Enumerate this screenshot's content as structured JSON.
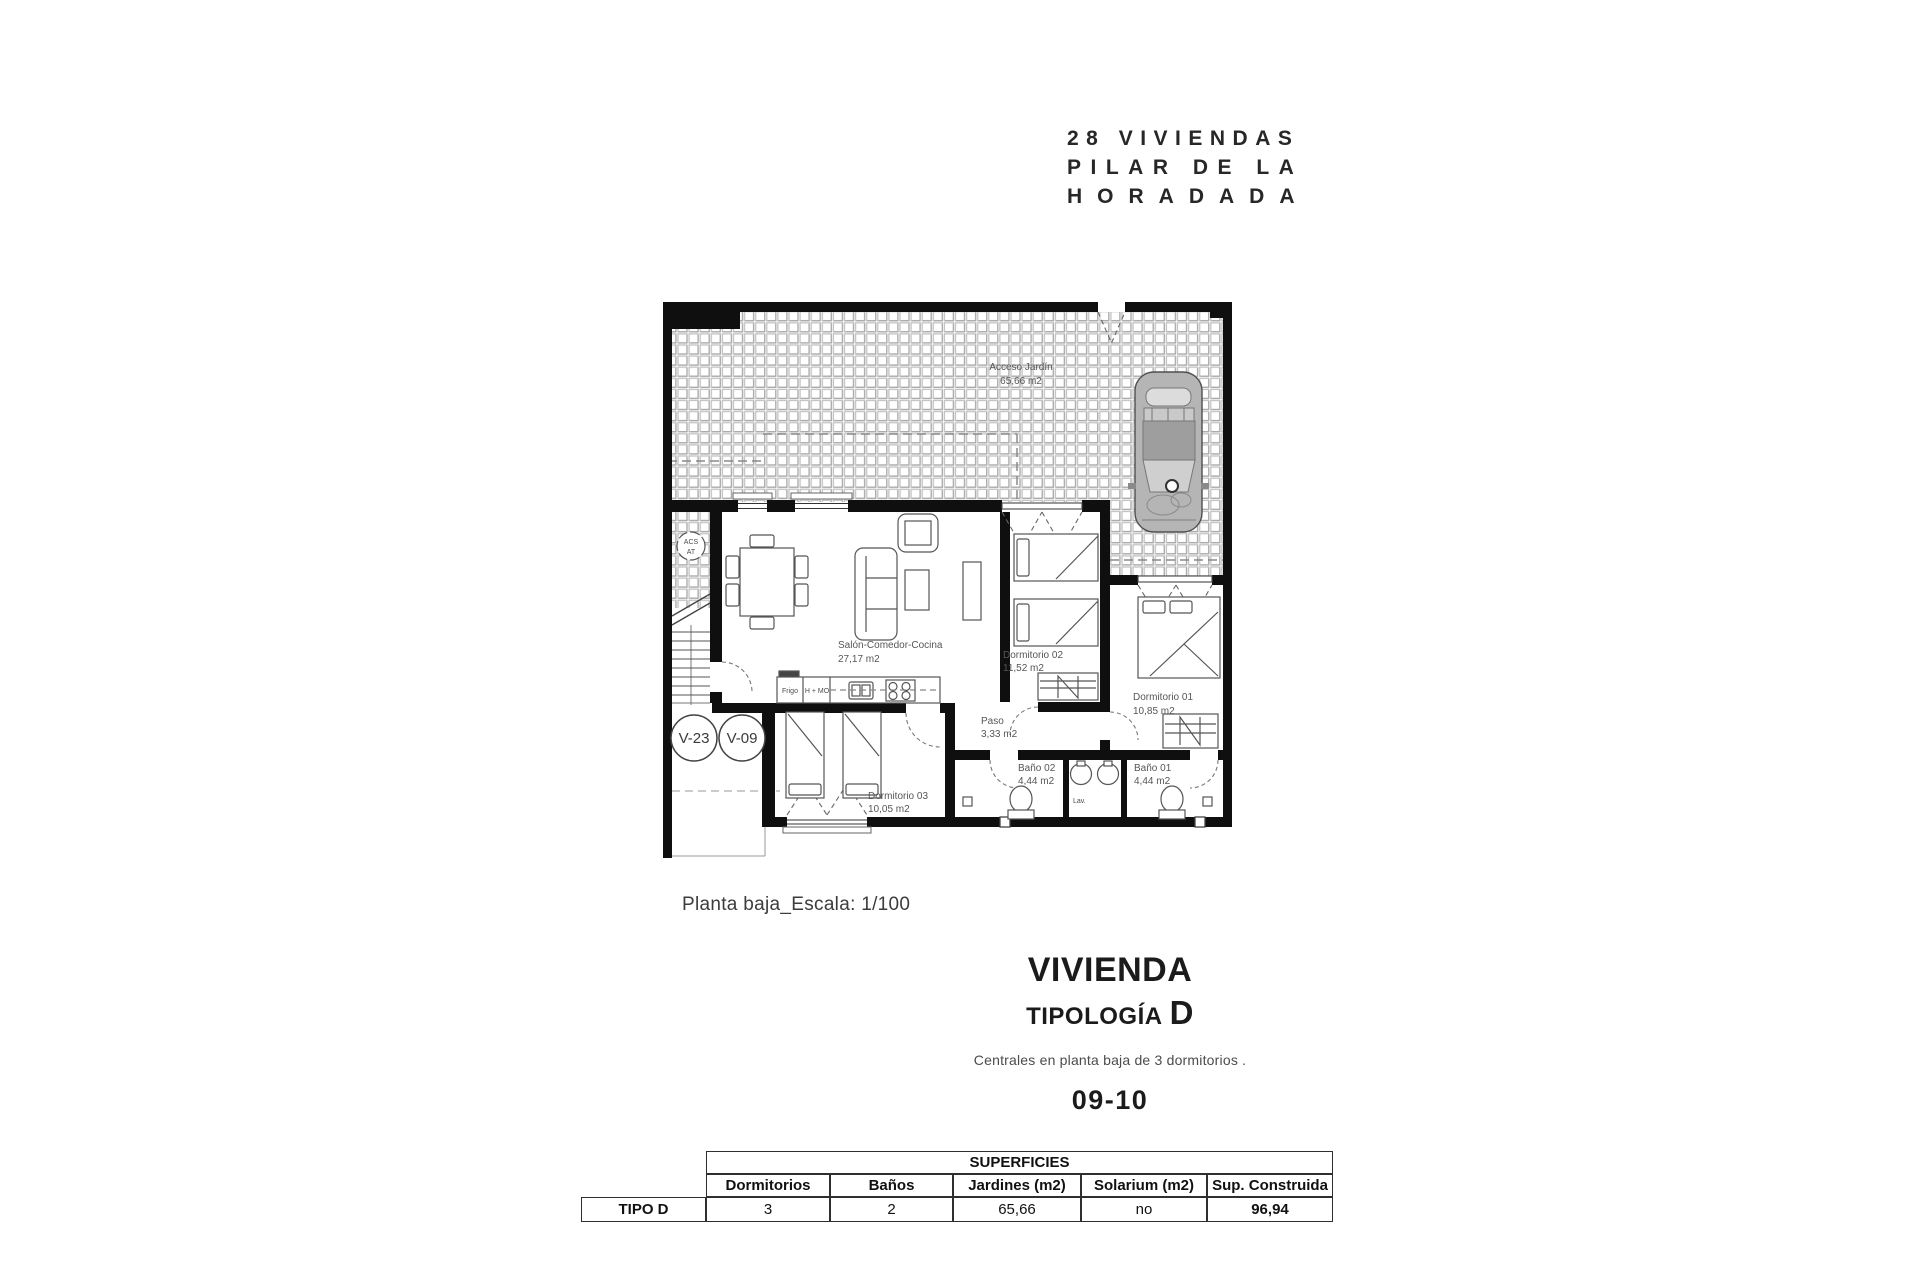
{
  "project_title": {
    "line1": "28 VIVIENDAS",
    "line2": "PILAR DE LA",
    "line3": "HORADADA"
  },
  "plan": {
    "garden_label": {
      "name": "Acceso Jardín",
      "area": "65,66 m2"
    },
    "rooms": {
      "salon": {
        "name": "Salón-Comedor-Cocina",
        "area": "27,17 m2"
      },
      "dormitorio01": {
        "name": "Dormitorio 01",
        "area": "10,85 m2"
      },
      "dormitorio02": {
        "name": "Dormitorio 02",
        "area": "11,52 m2"
      },
      "dormitorio03": {
        "name": "Dormitorio 03",
        "area": "10,05 m2"
      },
      "paso": {
        "name": "Paso",
        "area": "3,33 m2"
      },
      "bano01": {
        "name": "Baño 01",
        "area": "4,44 m2"
      },
      "bano02": {
        "name": "Baño 02",
        "area": "4,44 m2"
      }
    },
    "annotations": {
      "acs": "ACS",
      "at": "AT",
      "lav": "Lav.",
      "frigo": "Frigo",
      "h_mo": "H + MO",
      "v23": "V-23",
      "v09": "V-09"
    }
  },
  "scale_caption": "Planta baja_Escala: 1/100",
  "heading": {
    "title": "VIVIENDA",
    "subtitle_label": "TIPOLOGÍA",
    "subtitle_letter": "D",
    "description": "Centrales en planta baja de 3 dormitorios .",
    "units_range": "09-10"
  },
  "surfaces_table": {
    "group_header": "SUPERFICIES",
    "columns": [
      "Dormitorios",
      "Baños",
      "Jardines (m2)",
      "Solarium (m2)",
      "Sup. Construida"
    ],
    "row_label": "TIPO D",
    "values": [
      "3",
      "2",
      "65,66",
      "no",
      "96,94"
    ]
  },
  "colors": {
    "wall": "#0f0f0f",
    "tile_line": "#bfbfbf"
  }
}
